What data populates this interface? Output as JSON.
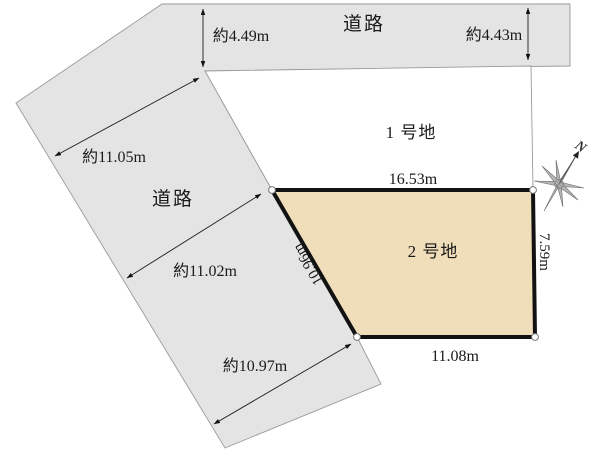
{
  "diagram": {
    "type": "land-subdivision-plan",
    "roads": {
      "top": {
        "label": "道路",
        "width_left": "約4.49m",
        "width_right": "約4.43m"
      },
      "side": {
        "label": "道路",
        "width_top": "約11.05m",
        "width_middle": "約11.02m",
        "width_bottom": "約10.97m"
      }
    },
    "plots": {
      "plot1": {
        "label": "1 号地"
      },
      "plot2": {
        "label": "2 号地",
        "dim_top": "16.53m",
        "dim_right": "7.59m",
        "dim_bottom": "11.08m",
        "dim_left": "10.96m"
      }
    },
    "compass": {
      "north_label": "N",
      "icon": "compass-rose-north-icon"
    },
    "colors": {
      "road_fill": "#e4e4e4",
      "road_border": "#9a9a9a",
      "plot1_fill": "#ffffff",
      "plot2_fill": "#f0deba",
      "plot2_border": "#121212",
      "text": "#1a1a1a"
    }
  }
}
